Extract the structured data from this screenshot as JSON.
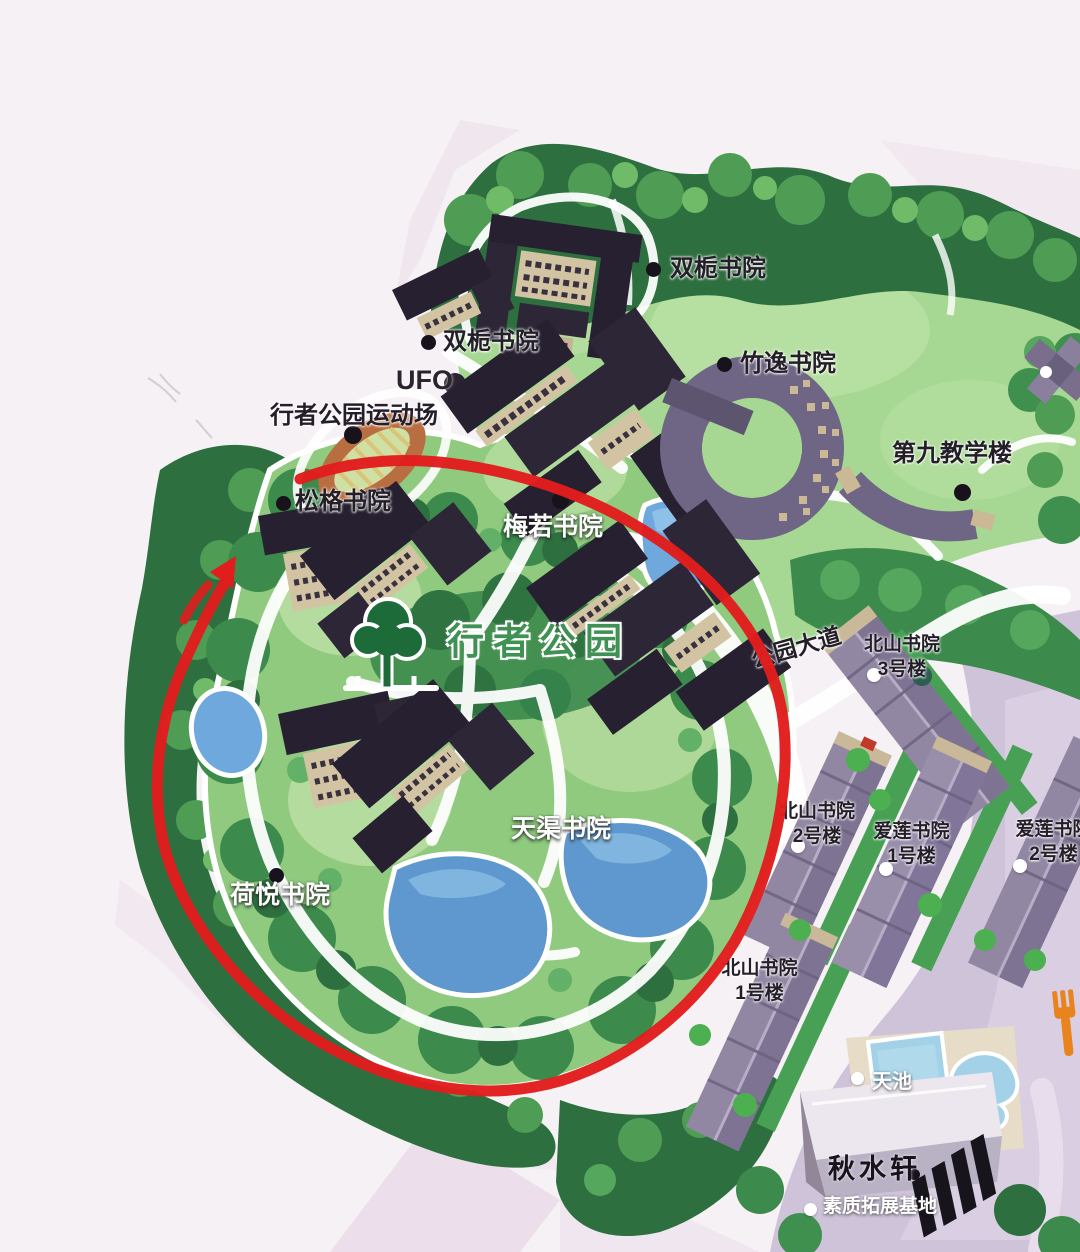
{
  "map": {
    "title": "行者公园 campus illustrated map",
    "labels": {
      "shuangzhi_top": "双栀书院",
      "shuangzhi_west": "双栀书院",
      "ufo": "UFO",
      "sports_field": "行者公园运动场",
      "zhuyi": "竹逸书院",
      "songge": "松格书院",
      "meiruo": "梅若书院",
      "ninth_teaching": "第九教学楼",
      "walker_park": "行者公园",
      "park_avenue": "公园大道",
      "tianqu": "天渠书院",
      "heyue": "荷悦书院",
      "qiushui": "秋水轩",
      "tianchi": "天池",
      "suzhi_base": "素质拓展基地",
      "beishan": {
        "name": "北山书院",
        "b1": "1号楼",
        "b2": "2号楼",
        "b3": "3号楼"
      },
      "ailian": {
        "name": "爱莲书院",
        "b1": "1号楼",
        "b2": "2号楼"
      }
    },
    "icons": {
      "park_tree": "tree-icon",
      "dining_fork": "fork-icon",
      "route_arrow": "arrow-icon"
    },
    "colors": {
      "route_red": "#e11d1d",
      "park_text_green": "#3f9154",
      "fork_orange": "#e8831d",
      "pond_blue": "#5f98ce",
      "grass_green": "#a6d894",
      "tree_green": "#2e6f3f",
      "roof_dark": "#262031",
      "dorm_purple": "#9187a3",
      "plaza_lavender": "#cfc3da"
    }
  }
}
